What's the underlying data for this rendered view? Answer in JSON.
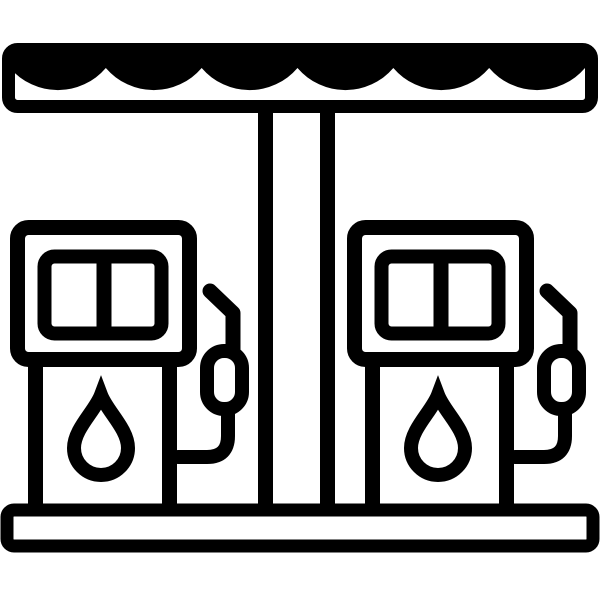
{
  "icon": {
    "name": "gas-station-icon",
    "label": "Gas station icon: scalloped canopy on a central pillar over two fuel pumps with display windows, fuel-drop symbols and hose nozzles, standing on a ground platform",
    "parts": {
      "canopy": "canopy-awning",
      "pillar": "support-pillar",
      "pump_left": "fuel-pump-left",
      "pump_right": "fuel-pump-right",
      "window": "pump-display-window",
      "drop": "fuel-drop",
      "nozzle": "fuel-nozzle",
      "hose": "fuel-hose",
      "base": "ground-platform"
    }
  },
  "colors": {
    "ink": "#000000",
    "bg": "#ffffff"
  }
}
